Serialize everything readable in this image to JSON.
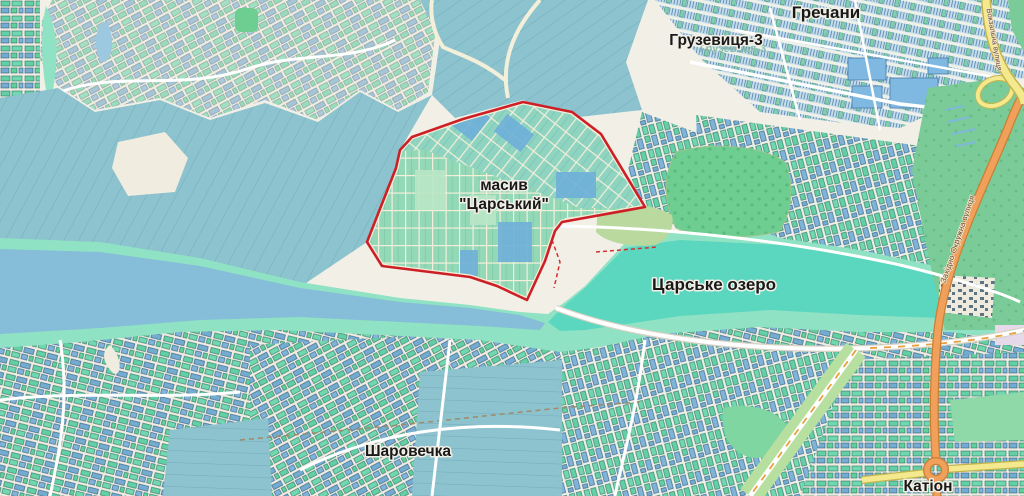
{
  "map": {
    "labels": {
      "grechany": "Гречани",
      "hruzevytsia": "Грузевиця-3",
      "masyv_line1": "масив",
      "masyv_line2": "\"Царський\"",
      "lake": "Царське озеро",
      "sharovechka": "Шаровечка",
      "kation": "Катіон",
      "road_zakhidna": "Західно-Окружна вулиця",
      "road_vokzalna": "Вокзальна вулиця"
    },
    "colors": {
      "background": "#f2efe7",
      "field": "#8cc3ce",
      "water_river": "#86bdd8",
      "water_lake": "#5bd6bf",
      "wetland": "#8fe2c3",
      "parcel_green": "#63cfa6",
      "parcel_blue": "#74accf",
      "forest_green": "#6ecd90",
      "outline_red": "#cd2026",
      "road_yellow": "#f4e98e",
      "road_orange": "#f0a05a",
      "label_dark": "#191919"
    }
  }
}
